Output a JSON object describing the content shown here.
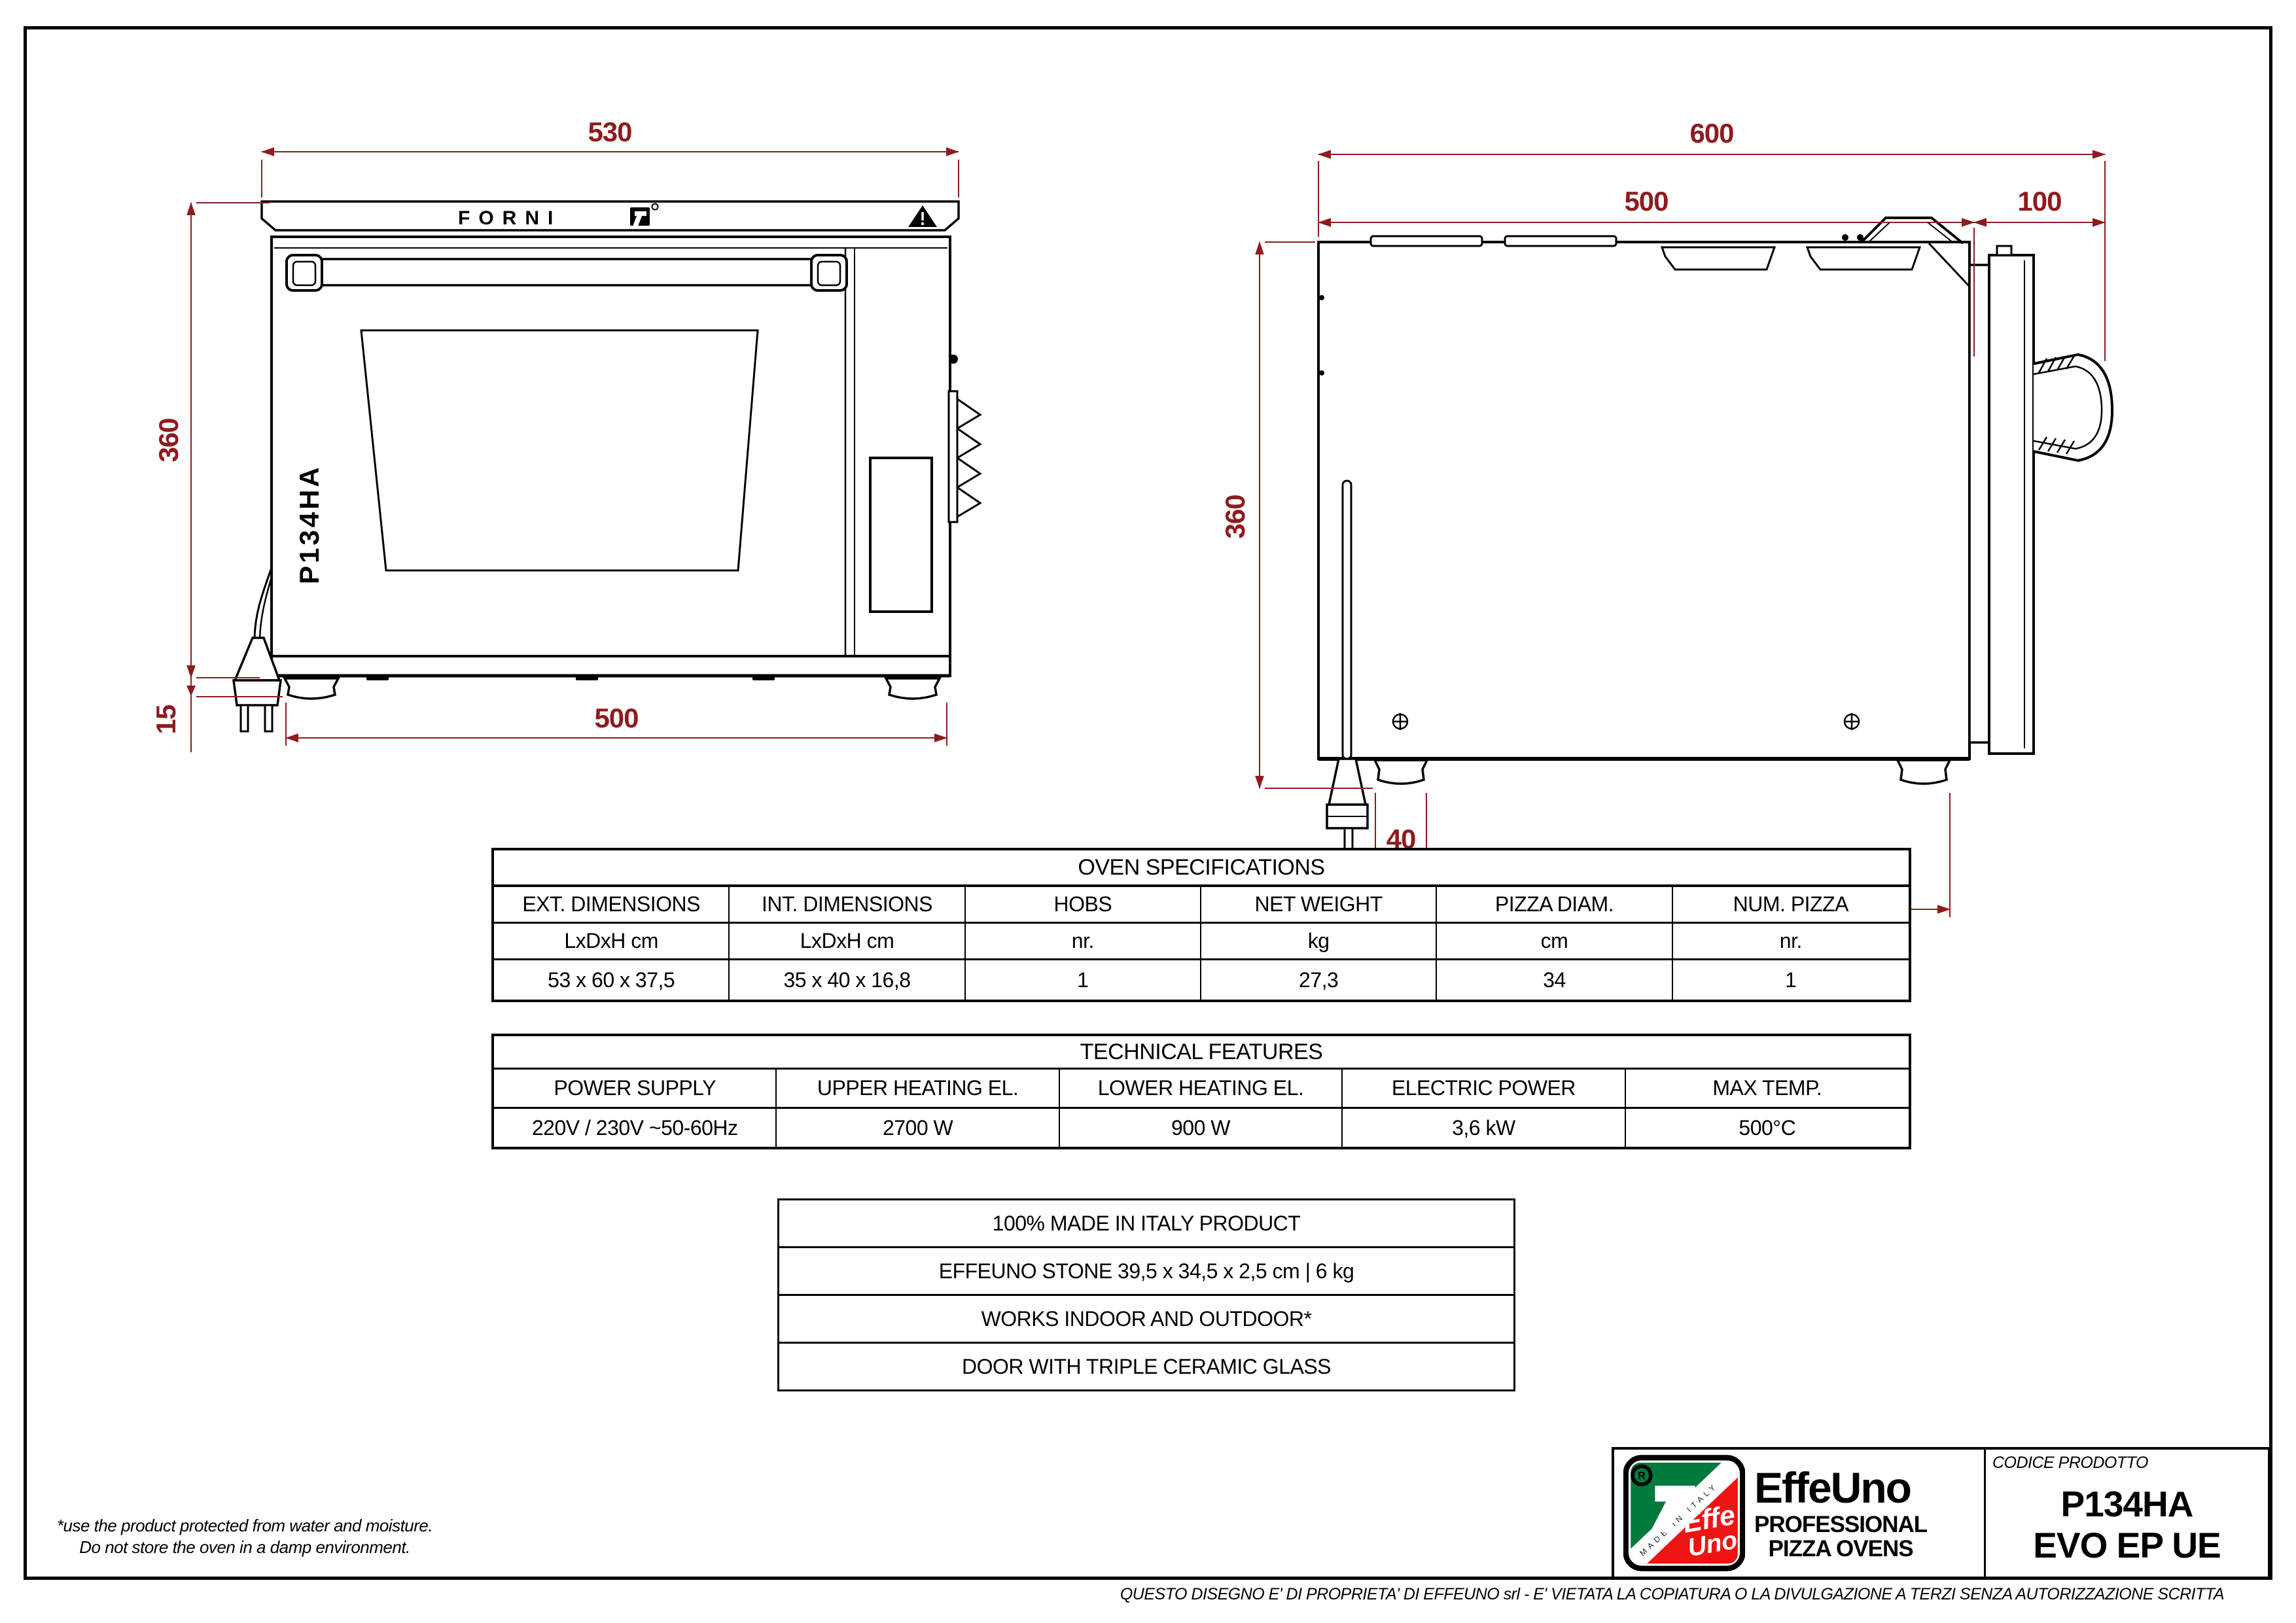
{
  "front_view": {
    "brand_text": "FORNI",
    "model_text": "P134HA",
    "dims": {
      "width_top": "530",
      "height": "360",
      "feet_height": "15",
      "width_bottom": "500"
    }
  },
  "side_view": {
    "dims": {
      "total_depth": "600",
      "body_depth": "500",
      "handle_depth": "100",
      "height": "360",
      "foot_width": "40",
      "feet_span": "440"
    }
  },
  "spec_table": {
    "title": "OVEN SPECIFICATIONS",
    "columns": [
      {
        "header": "EXT. DIMENSIONS",
        "unit": "LxDxH cm",
        "value": "53 x 60 x 37,5"
      },
      {
        "header": "INT. DIMENSIONS",
        "unit": "LxDxH cm",
        "value": "35 x 40 x 16,8"
      },
      {
        "header": "HOBS",
        "unit": "nr.",
        "value": "1"
      },
      {
        "header": "NET WEIGHT",
        "unit": "kg",
        "value": "27,3"
      },
      {
        "header": "PIZZA DIAM.",
        "unit": "cm",
        "value": "34"
      },
      {
        "header": "NUM. PIZZA",
        "unit": "nr.",
        "value": "1"
      }
    ]
  },
  "tech_table": {
    "title": "TECHNICAL FEATURES",
    "columns": [
      {
        "header": "POWER SUPPLY",
        "value": "220V / 230V ~50-60Hz"
      },
      {
        "header": "UPPER HEATING EL.",
        "value": "2700 W"
      },
      {
        "header": "LOWER HEATING EL.",
        "value": "900 W"
      },
      {
        "header": "ELECTRIC POWER",
        "value": "3,6 kW"
      },
      {
        "header": "MAX TEMP.",
        "value": "500°C"
      }
    ]
  },
  "features_list": [
    "100% MADE IN ITALY PRODUCT",
    "EFFEUNO STONE 39,5 x 34,5 x 2,5 cm | 6 kg",
    "WORKS INDOOR AND OUTDOOR*",
    "DOOR WITH TRIPLE CERAMIC GLASS"
  ],
  "title_block": {
    "brand": "EffeUno",
    "brand_sub1": "PROFESSIONAL",
    "brand_sub2": "PIZZA OVENS",
    "logo_made_in": "MADE IN ITALY",
    "logo_script_top": "Effe",
    "logo_script_bottom": "Uno",
    "registered_mark": "R",
    "code_label": "CODICE PRODOTTO",
    "code_line1": "P134HA",
    "code_line2": "EVO EP UE"
  },
  "notes": {
    "footnote_line1": "*use the product protected from water and moisture.",
    "footnote_line2": "Do not store the oven in a damp environment.",
    "disclaimer": "QUESTO DISEGNO E' DI PROPRIETA' DI EFFEUNO srl - E' VIETATA LA COPIATURA O LA DIVULGAZIONE A TERZI SENZA AUTORIZZAZIONE SCRITTA"
  },
  "colors": {
    "dimension_red": "#8e1b1e",
    "line_black": "#000000",
    "flag_green": "#007A3D",
    "flag_red": "#EE1414"
  }
}
